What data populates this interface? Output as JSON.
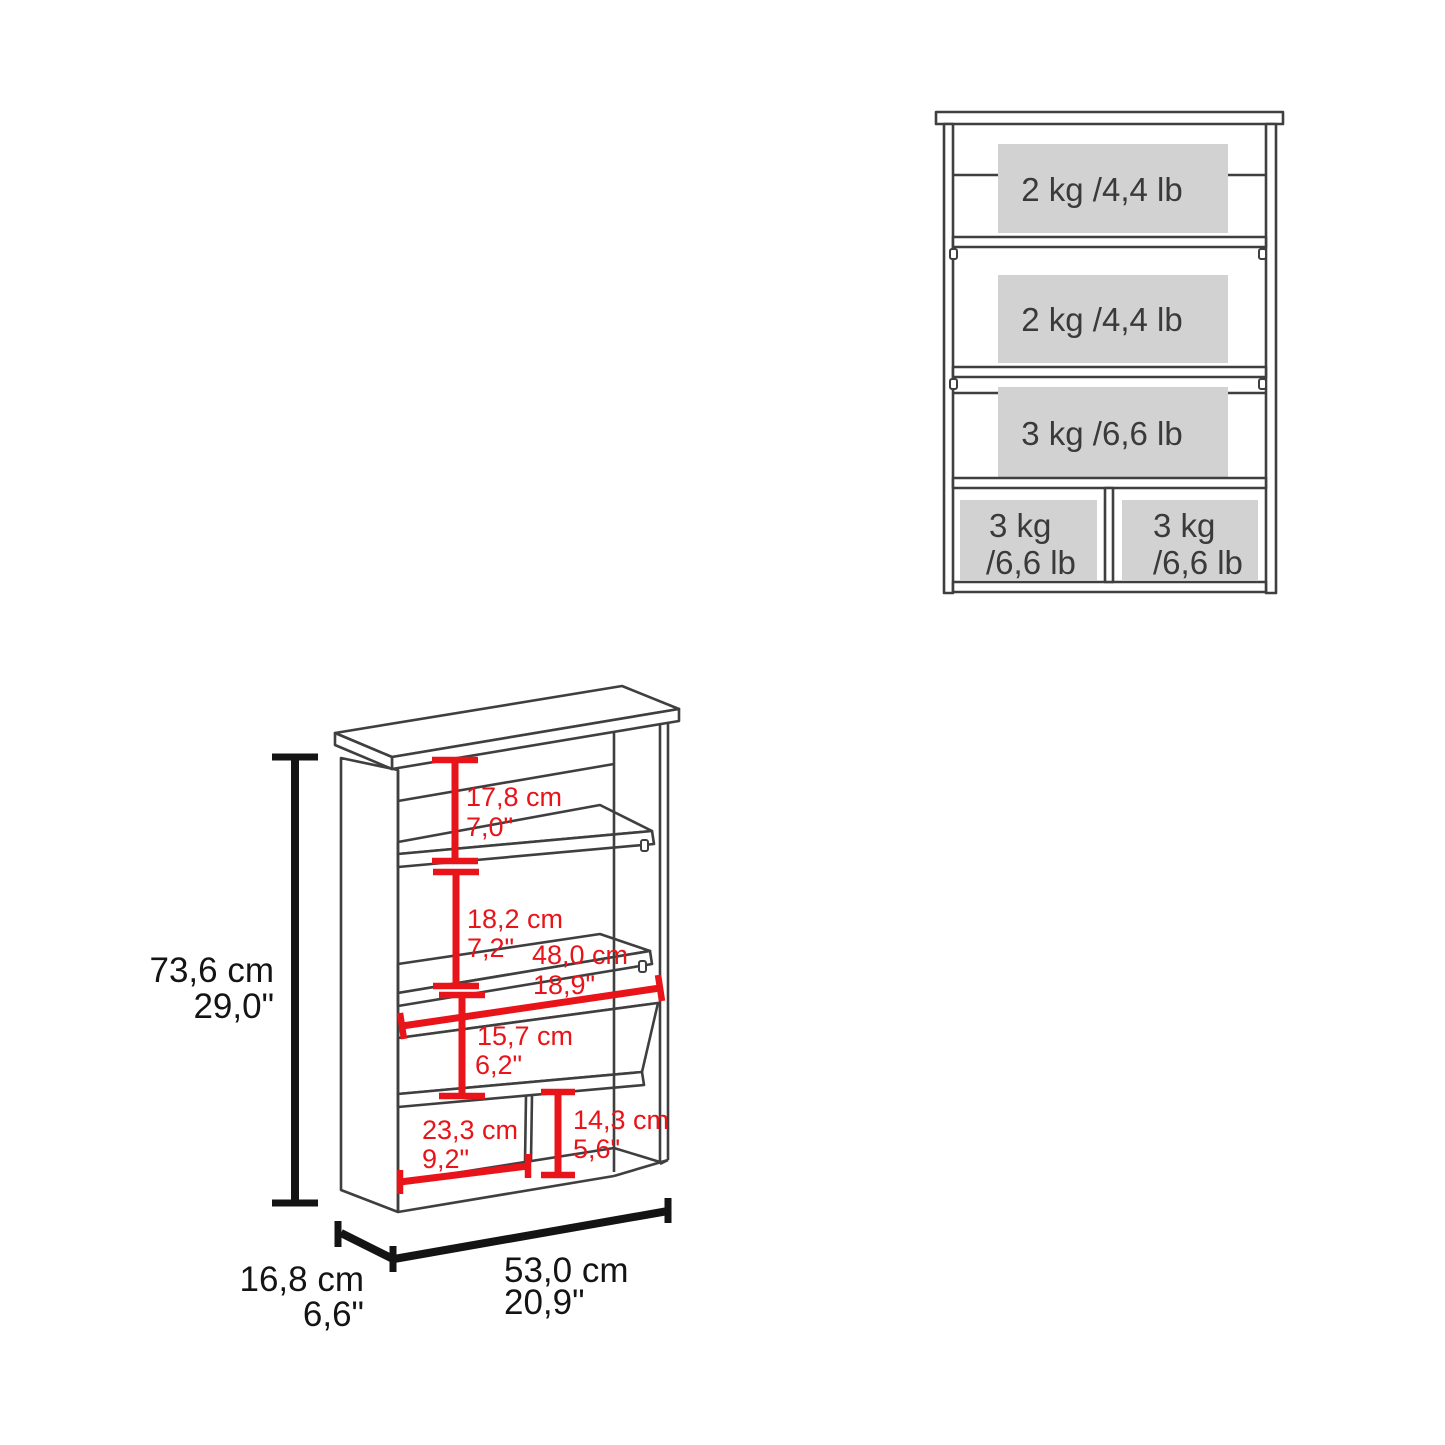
{
  "front_view": {
    "shelf_labels": [
      "2 kg /4,4 lb",
      "2 kg /4,4 lb",
      "3 kg /6,6 lb"
    ],
    "left_compartment": {
      "line1": "3 kg",
      "line2": "/6,6 lb"
    },
    "right_compartment": {
      "line1": "3 kg",
      "line2": "/6,6 lb"
    }
  },
  "dimension_view": {
    "overall_height_cm": "73,6 cm",
    "overall_height_in": "29,0\"",
    "top_shelf_space_cm": "17,8 cm",
    "top_shelf_space_in": "7,0\"",
    "middle_shelf_space_cm": "18,2 cm",
    "middle_shelf_space_in": "7,2\"",
    "shelf_width_cm": "48,0 cm",
    "shelf_width_in": "18,9\"",
    "lower_shelf_space_cm": "15,7 cm",
    "lower_shelf_space_in": "6,2\"",
    "left_compartment_width_cm": "23,3 cm",
    "left_compartment_width_in": "9,2\"",
    "right_compartment_height_cm": "14,3 cm",
    "right_compartment_height_in": "5,6\"",
    "depth_cm": "16,8 cm",
    "depth_in": "6,6\"",
    "overall_width_cm": "53,0 cm",
    "overall_width_in": "20,9\""
  },
  "colors": {
    "outline": "#3f3f3f",
    "dimension": "#e81419",
    "label_bg": "#d2d2d2",
    "text": "#3a3a3a",
    "black_dim": "#141414"
  }
}
